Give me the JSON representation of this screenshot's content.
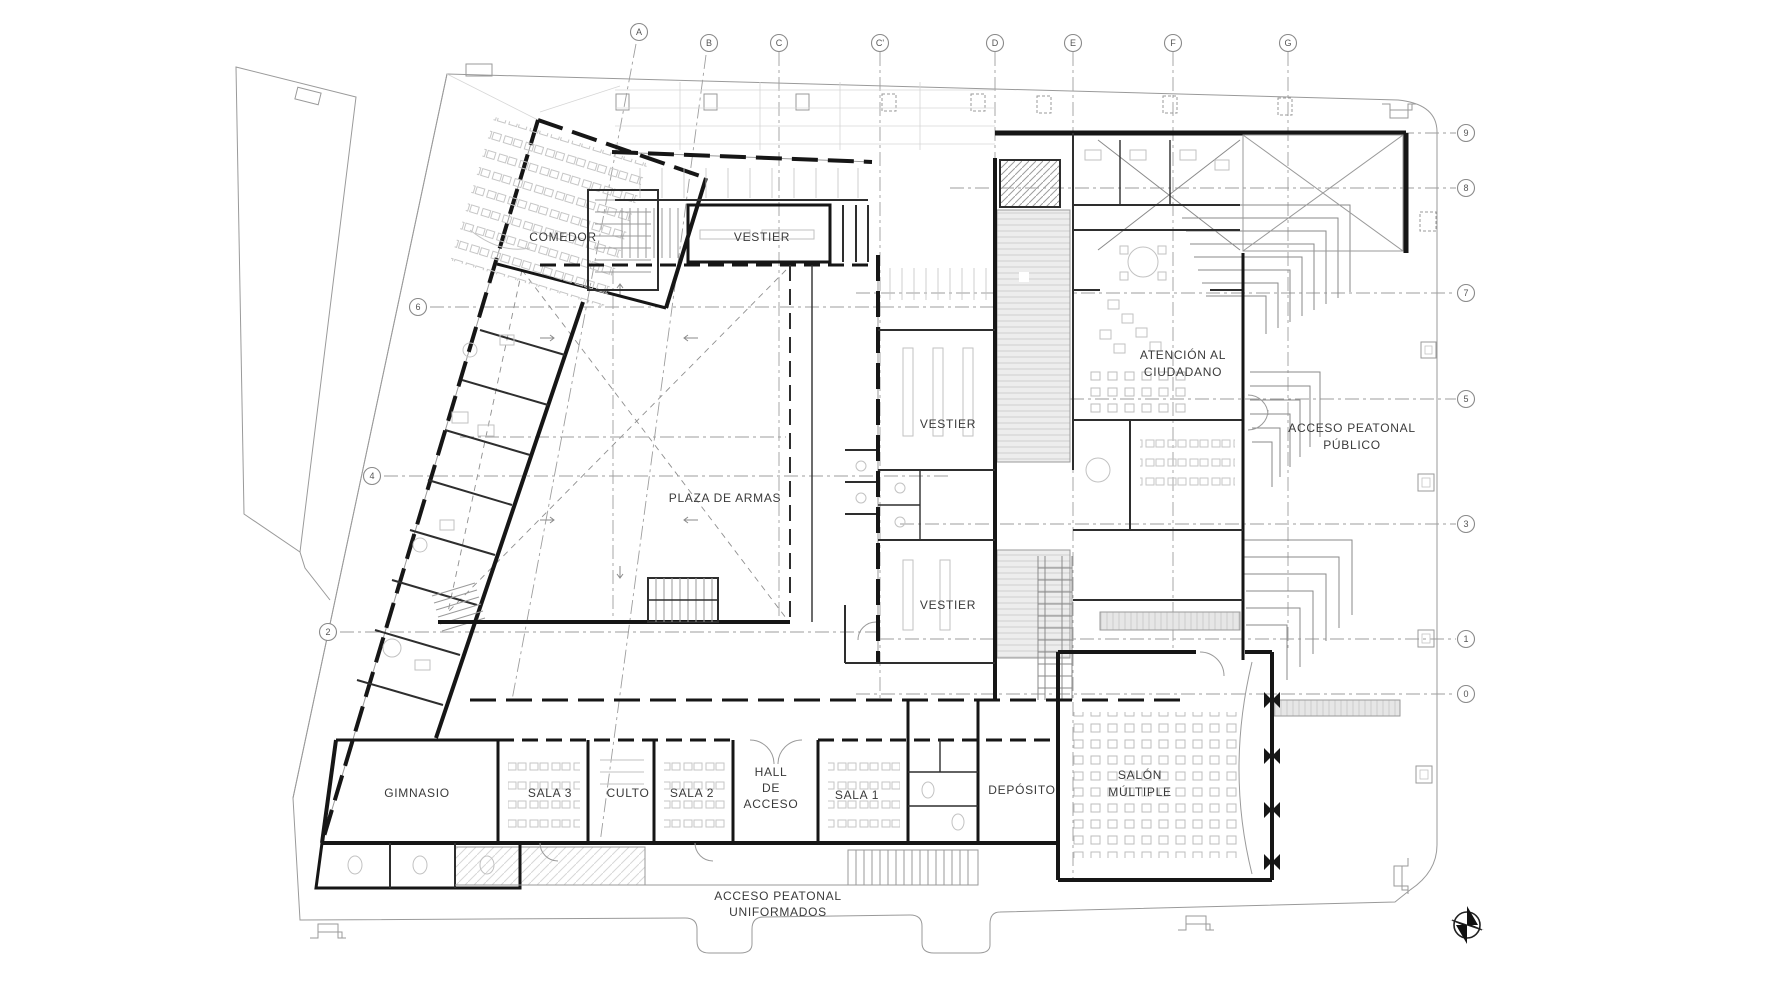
{
  "document": {
    "type": "architectural-floor-plan",
    "language": "es"
  },
  "labels": {
    "comedor": "COMEDOR",
    "vestier_top": "VESTIER",
    "vestier_mid": "VESTIER",
    "vestier_low": "VESTIER",
    "plaza": "PLAZA DE ARMAS",
    "atencion_line1": "ATENCIÓN AL",
    "atencion_line2": "CIUDADANO",
    "acceso_publico_line1": "ACCESO PEATONAL",
    "acceso_publico_line2": "PÚBLICO",
    "gimnasio": "GIMNASIO",
    "sala3": "SALA 3",
    "culto": "CULTO",
    "sala2": "SALA 2",
    "hall_line1": "HALL",
    "hall_line2": "DE",
    "hall_line3": "ACCESO",
    "sala1": "SALA 1",
    "deposito": "DEPÓSITO",
    "salon_line1": "SALÓN",
    "salon_line2": "MÚLTIPLE",
    "acceso_uniformados_line1": "ACCESO PEATONAL",
    "acceso_uniformados_line2": "UNIFORMADOS"
  },
  "grid": {
    "top": [
      "A",
      "B",
      "C",
      "C'",
      "D",
      "E",
      "F",
      "G"
    ],
    "right": [
      "9",
      "8",
      "7",
      "5",
      "3",
      "1",
      "0"
    ],
    "left": [
      "6",
      "4",
      "2"
    ]
  },
  "icons": {
    "compass": "compass-north-icon"
  },
  "colors": {
    "background": "#ffffff",
    "wall": "#161616",
    "partition": "#2e2e2e",
    "light_line": "#9a9a9a",
    "grid_line": "#9e9e9e",
    "furniture": "#c2c2c2",
    "fill_light": "#ececec",
    "text": "#3a3a3a"
  }
}
